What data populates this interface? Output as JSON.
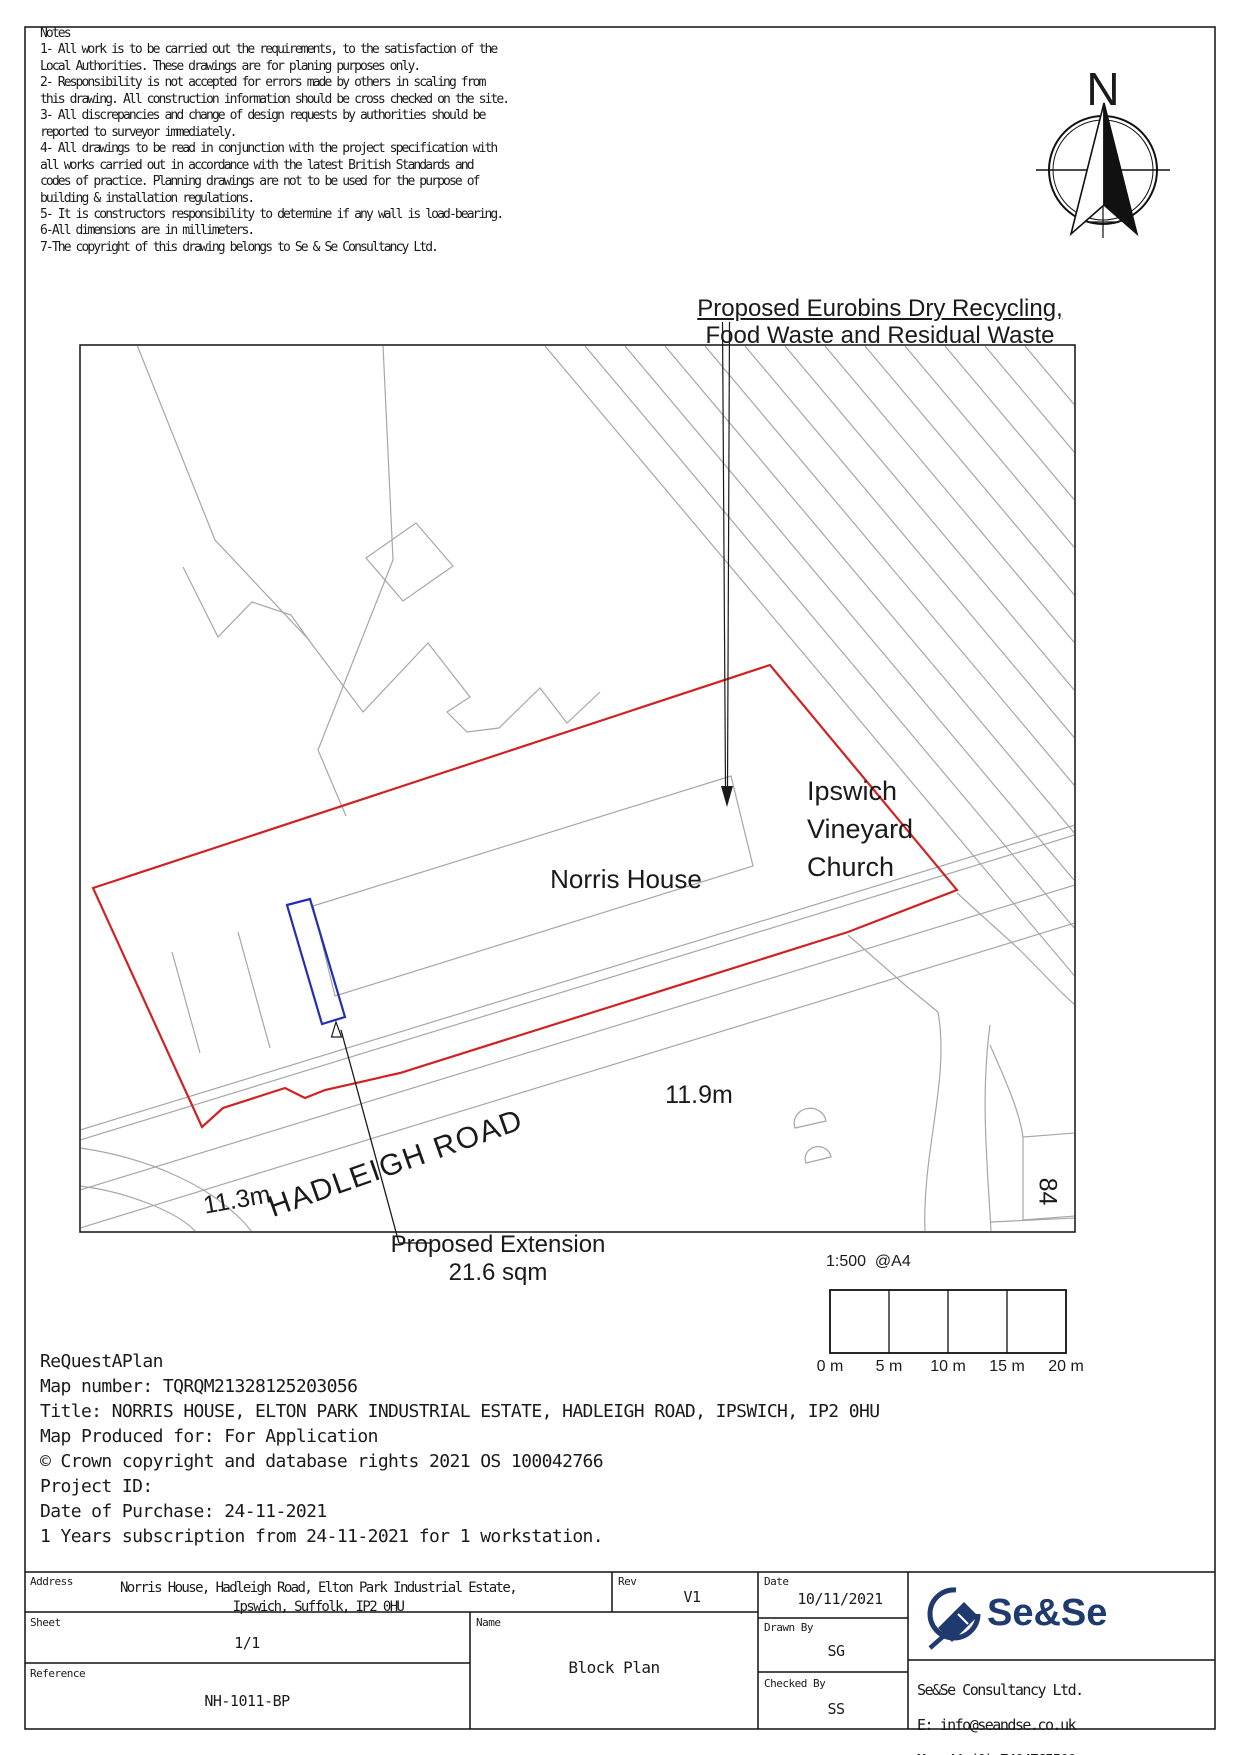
{
  "notes": {
    "text": "Notes\n1- All work is to be carried out the requirements, to the satisfaction of the\nLocal Authorities. These drawings are for planing purposes only.\n2- Responsibility is not accepted for errors made by others in scaling from\nthis drawing. All construction information should be cross checked on the site.\n3- All discrepancies and change of design requests by authorities should be\nreported to surveyor immediately.\n4- All drawings to be read in conjunction with the project specification with\nall works carried out in accordance with the latest British Standards and\ncodes of practice. Planning drawings are not to be used for the purpose of\nbuilding & installation regulations.\n5- It is constructors responsibility to determine if any wall is load-bearing.\n6-All dimensions are in millimeters.\n7-The copyright of this drawing belongs to Se & Se Consultancy Ltd."
  },
  "compass": {
    "north_label": "N"
  },
  "map": {
    "eurobins_annotation": {
      "line1": "Proposed Eurobins Dry Recycling,",
      "line2": "Food Waste and Residual Waste"
    },
    "extension_annotation": {
      "line1": "Proposed Extension",
      "line2": "21.6 sqm"
    },
    "labels": {
      "building": "Norris House",
      "church1": "Ipswich",
      "church2": "Vineyard",
      "church3": "Church",
      "spot_height_site": "11.9m",
      "spot_height_road": "11.3m",
      "road_name": "HADLEIGH ROAD",
      "building_number": "84"
    }
  },
  "scale_bar": {
    "title": "1:500  @A4",
    "ticks": [
      "0 m",
      "5 m",
      "10 m",
      "15 m",
      "20 m"
    ]
  },
  "map_info": {
    "text": "ReQuestAPlan\nMap number: TQRQM21328125203056\nTitle: NORRIS HOUSE, ELTON PARK INDUSTRIAL ESTATE, HADLEIGH ROAD, IPSWICH, IP2 0HU\nMap Produced for: For Application\n© Crown copyright and database rights 2021 OS 100042766\nProject ID:\nDate of Purchase: 24-11-2021\n1 Years subscription from 24-11-2021 for 1 workstation."
  },
  "title_block": {
    "address": {
      "label": "Address",
      "line1": "Norris House, Hadleigh Road, Elton Park Industrial Estate,",
      "line2": "Ipswich, Suffolk, IP2 0HU"
    },
    "sheet": {
      "label": "Sheet",
      "value": "1/1"
    },
    "reference": {
      "label": "Reference",
      "value": "NH-1011-BP"
    },
    "rev": {
      "label": "Rev",
      "value": "V1"
    },
    "name": {
      "label": "Name",
      "value": "Block Plan"
    },
    "date": {
      "label": "Date",
      "value": "10/11/2021"
    },
    "drawn_by": {
      "label": "Drawn By",
      "value": "SG"
    },
    "checked_by": {
      "label": "Checked By",
      "value": "SS"
    }
  },
  "branding": {
    "logo_text": "Se&Se",
    "company": "Se&Se Consultancy Ltd.",
    "email": "E: info@seandse.co.uk",
    "phone": "M: +44 (0) 7404765500",
    "website": "W: www.seandse.co.uk"
  },
  "colors": {
    "boundary_red": "#cf2323",
    "extension_blue": "#2230b0",
    "map_gray": "#a6a6a6",
    "logo_navy": "#1f3a6e",
    "ink": "#1a1a1a"
  }
}
